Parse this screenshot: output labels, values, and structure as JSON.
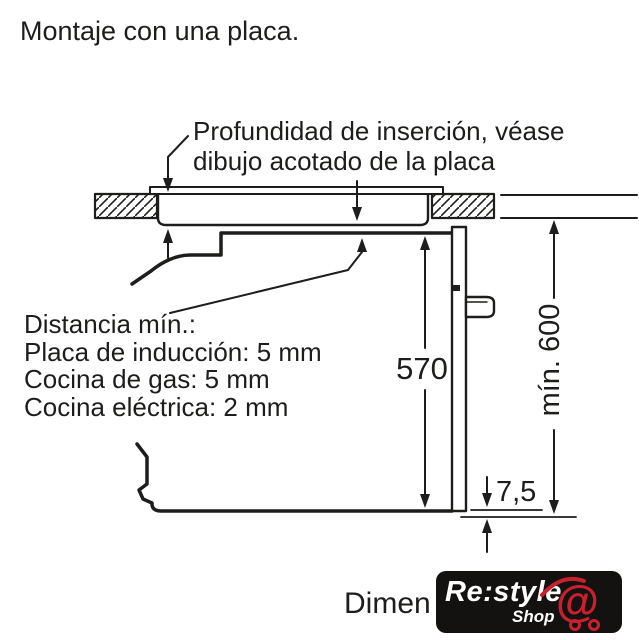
{
  "page": {
    "title": "Montaje con una placa.",
    "line_color": "#1d1d1b",
    "background": "#ffffff"
  },
  "annotations": {
    "insertion_note_line1": "Profundidad de inserción, véase",
    "insertion_note_line2": "dibujo acotado de la placa",
    "clearance_title": "Distancia mín.:",
    "clearance_items": [
      "Placa de inducción: 5 mm",
      "Cocina de gas: 5 mm",
      "Cocina eléctrica: 2 mm"
    ]
  },
  "dimensions": {
    "oven_height_mm": "570",
    "niche_height_mm": "mín. 600",
    "door_overhang_mm": "7,5"
  },
  "caption": {
    "partial_text": "Dimen"
  },
  "watermark": {
    "brand": "Re:style",
    "sub": "Shop",
    "at_symbol": "@",
    "background": "#141210",
    "red": "#c9202e",
    "white": "#ffffff"
  }
}
